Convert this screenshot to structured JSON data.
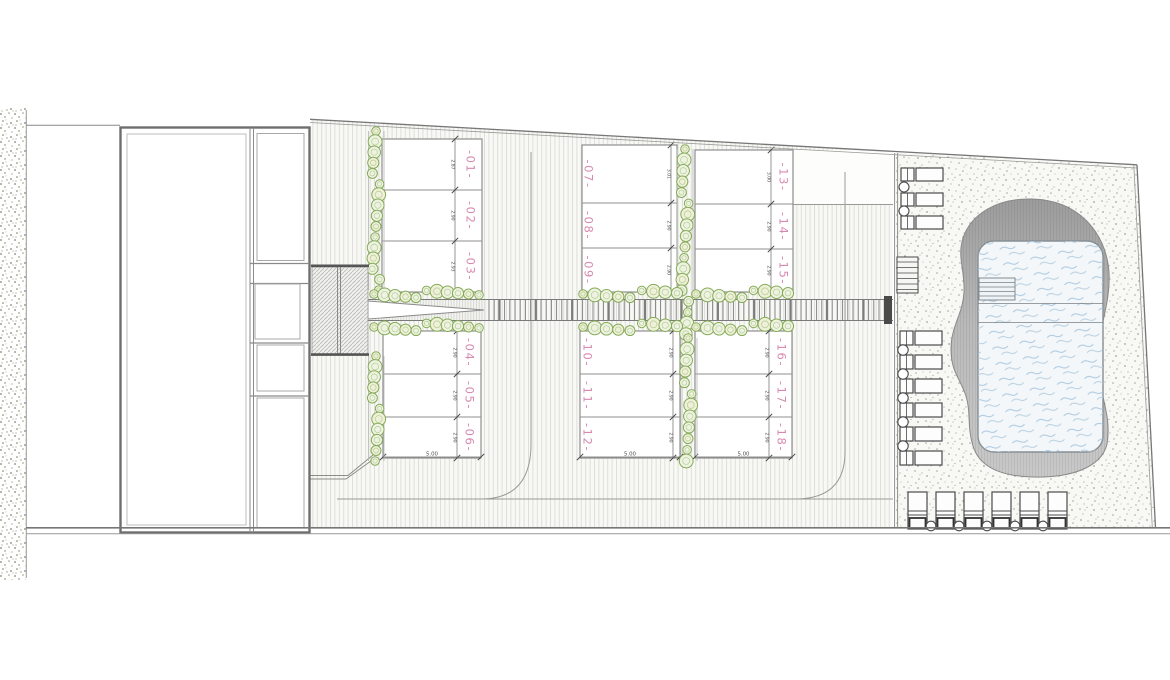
{
  "level_marker": "+1.30",
  "pitch_columns": [
    {
      "id": "top-left",
      "plots": [
        {
          "label": "-01-",
          "depth": "2.87"
        },
        {
          "label": "-02-",
          "depth": "2.90"
        },
        {
          "label": "-03-",
          "depth": "2.93"
        }
      ]
    },
    {
      "id": "top-middle",
      "plots": [
        {
          "label": "-07-",
          "depth": "3.01"
        },
        {
          "label": "-08-",
          "depth": "2.90"
        },
        {
          "label": "-09-",
          "depth": "2.90"
        }
      ]
    },
    {
      "id": "top-right",
      "plots": [
        {
          "label": "-13-",
          "depth": "3.00"
        },
        {
          "label": "-14-",
          "depth": "2.90"
        },
        {
          "label": "-15-",
          "depth": "2.90"
        }
      ]
    },
    {
      "id": "bottom-left",
      "width": "5.00",
      "plots": [
        {
          "label": "-04-",
          "depth": "2.90"
        },
        {
          "label": "-05-",
          "depth": "2.90"
        },
        {
          "label": "-06-",
          "depth": "2.90"
        }
      ]
    },
    {
      "id": "bottom-middle",
      "width": "5.00",
      "plots": [
        {
          "label": "-10-",
          "depth": "2.90"
        },
        {
          "label": "-11-",
          "depth": "2.90"
        },
        {
          "label": "-12-",
          "depth": "2.90"
        }
      ]
    },
    {
      "id": "bottom-right",
      "width": "5.00",
      "plots": [
        {
          "label": "-16-",
          "depth": "2.90"
        },
        {
          "label": "-17-",
          "depth": "2.90"
        },
        {
          "label": "-18-",
          "depth": "2.90"
        }
      ]
    }
  ],
  "symbols": {
    "tree": "tree-icon",
    "sun_lounger": "sun-lounger-icon",
    "side_table": "side-table-icon",
    "pool_steps": "pool-steps-icon",
    "pool": "swimming-pool",
    "building": "reception-building"
  },
  "colors": {
    "plot_label": "#d78ab0",
    "tree_stroke": "#86ab58",
    "tree_fill": "#eef3e1",
    "tree_fill_alt": "#eef0d8",
    "water_wave": "#a9c6de",
    "water_fill": "#f3f7fa",
    "deck": "#b5b5b5",
    "dim_text": "#4a4a4a",
    "wall": "#6e6e6e",
    "line": "#8f8f8f"
  }
}
